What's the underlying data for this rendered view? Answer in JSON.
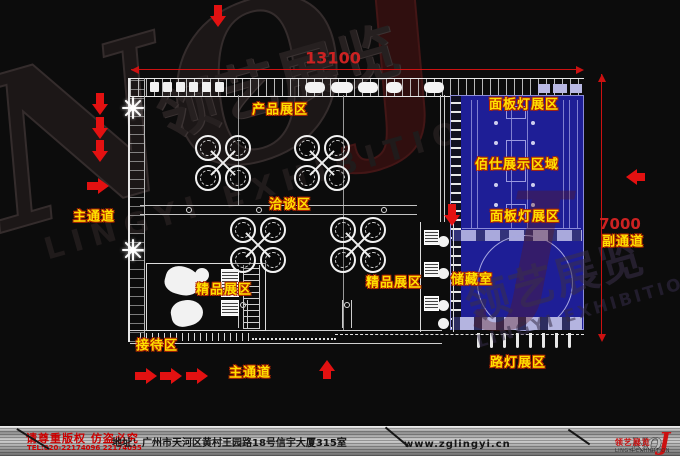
{
  "watermark": {
    "brand_no": "NO",
    "brand_j": "J",
    "cn": "领艺展览",
    "en": "LINGYI EXHIBITION"
  },
  "dimensions": {
    "top": "13100",
    "right": "7000"
  },
  "areas": {
    "product": "产品展区",
    "panel_light_top": "面板灯展区",
    "baishi_display": "佰仕展示区域",
    "negotiation": "洽谈区",
    "panel_light_bottom": "面板灯展区",
    "main_aisle_left": "主通道",
    "side_aisle": "副通道",
    "boutique_left": "精品展区",
    "boutique_right": "精品展区",
    "storage": "储藏室",
    "reception": "接待区",
    "main_aisle_bottom": "主通道",
    "street_lamp": "路灯展区"
  },
  "footer": {
    "copyright": "请尊重版权 仿盗必究",
    "tel": "TEL:020-22174096 22174095",
    "address": "地址：广州市天河区黄村王园路18号信宇大厦315室",
    "website": "www.zglingyi.cn",
    "logo_no": "NO",
    "logo_j": "J",
    "logo_cn": "领艺展览",
    "logo_en": "LINGYI EXHIBITION"
  },
  "icons": {
    "red-arrow": "solid red directional arrow (CSS triangle)",
    "plant": "white star plant symbol (CSS bars)"
  },
  "colors": {
    "background": "#0c0c0c",
    "cad_line": "#e0e0e0",
    "label_yellow": "#ffe000",
    "label_outline": "#b32400",
    "dimension_red": "#cc2222",
    "blue_zone": "#1e1e96",
    "blue_light": "#b4b4e0",
    "footer_red": "#cc0000"
  }
}
